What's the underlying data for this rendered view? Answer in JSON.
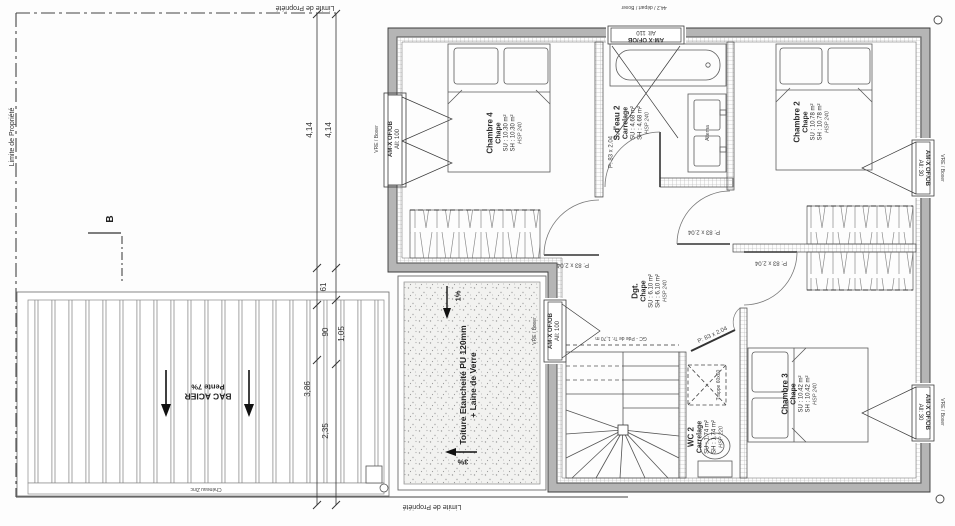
{
  "labels": {
    "limite": "Limite de Propriété",
    "section_b": "B",
    "door": "P: 83 x 2.04",
    "gc": "GC - Pde de Tr. 1,70 m",
    "trappe": "Trappe 60x60",
    "vanity": "Alterna",
    "gutter": "Chéneau Zinc"
  },
  "dims": {
    "a": "4,14",
    "b": "4,14",
    "c": "61",
    "d": "90",
    "e": "1,05",
    "f": "3,86",
    "g": "2,35"
  },
  "bac_acier": {
    "line1": "BAC ACIER",
    "line2": "Pente 7%"
  },
  "toiture": {
    "line1": "Toiture Etancheité PU 120mm",
    "line2": "+ Laine de Verre",
    "p1": "1%",
    "p3": "3%"
  },
  "windows": {
    "left": {
      "sys": "AM-X OF/OB",
      "al": "All: 100",
      "out": "VRE / Boxer"
    },
    "top": {
      "sys": "AM-X OF/OB",
      "al": "All: 110",
      "out": "44.2 / départ / Boxer"
    },
    "right_up": {
      "sys": "AM-X OF/OB",
      "al": "All: 30",
      "out": "VRE / Boxer"
    },
    "right_low": {
      "sys": "AM-X OF/OB",
      "al": "All: 30",
      "out": "VRE / Boxer"
    },
    "west": {
      "sys": "AM-X OF/OB",
      "al": "All: 100",
      "out": "VRE / Boxer"
    }
  },
  "rooms": {
    "chambre4": {
      "name": "Chambre 4",
      "finish": "Chape",
      "su": "SU : 10.30 m²",
      "sh": "SH : 10.30 m²",
      "hsp": "HSP 240"
    },
    "sdeau2": {
      "name": "S.d'eau 2",
      "finish": "Carrelage",
      "su": "SU : 4.68 m²",
      "sh": "SH : 4.68 m²",
      "hsp": "HSP 240"
    },
    "chambre2": {
      "name": "Chambre 2",
      "finish": "Chape",
      "su": "SU : 10.78 m²",
      "sh": "SH : 10.78 m²",
      "hsp": "HSP 240"
    },
    "dgt": {
      "name": "Dgt.",
      "finish": "Chape",
      "su": "SU : 6.10 m²",
      "sh": "SH : 6.10 m²",
      "hsp": "HSP 240"
    },
    "wc2": {
      "name": "WC 2",
      "finish": "Carrelage",
      "su": "SU : 1.74 m²",
      "sh": "SH : 1.74 m²",
      "hsp": "HSP 220"
    },
    "chambre3": {
      "name": "Chambre 3",
      "finish": "Chape",
      "su": "SU : 10.42 m²",
      "sh": "SH : 10.42 m²",
      "hsp": "HSP 240"
    }
  },
  "colors": {
    "wall": "#b5b5b5",
    "line": "#3a3a3a"
  }
}
